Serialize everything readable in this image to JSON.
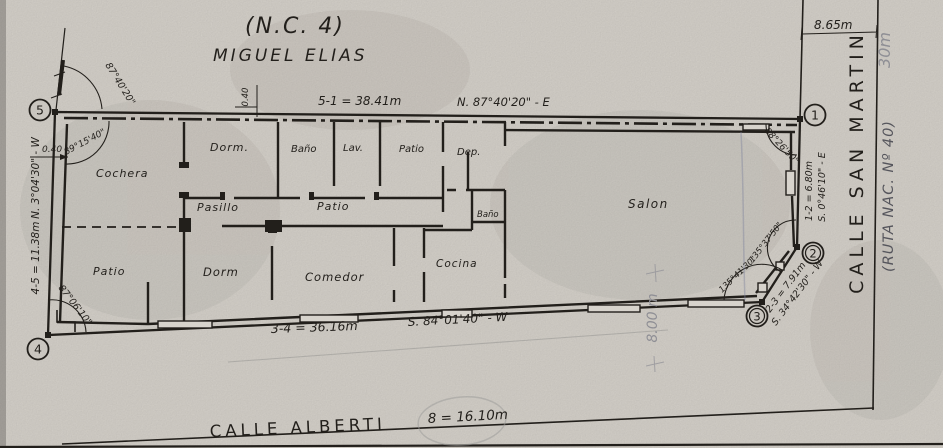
{
  "title": {
    "nc": "(N.C. 4)",
    "owner": "MIGUEL ELIAS"
  },
  "sides": {
    "north": {
      "dim": "5-1 = 38.41m",
      "bearing": "N. 87°40'20\" - E",
      "offset": "0.40"
    },
    "east": {
      "dim": "1-2 = 6.80m",
      "bearing": "S. 0°46'10\" - E",
      "corner_to_street": "8.65m"
    },
    "southeast": {
      "dim": "2-3 = 7.91m",
      "bearing": "S. 34°42'30\" - W"
    },
    "south": {
      "dim": "3-4 = 36.16m",
      "bearing": "S. 84°01'40\" - W"
    },
    "west": {
      "dim": "4-5 = 11.38m",
      "bearing": "N. 3°04'30\" - W",
      "offset": "0.40"
    }
  },
  "angles": {
    "v5_outer": "87°40'20\"",
    "v5_inner": "89°15'40\"",
    "v1": "88°26'50\"",
    "v2": "135°37'50\"",
    "v3": "135°41'30\"",
    "v4": "87°06'10\""
  },
  "vertices": {
    "v1": "1",
    "v2": "2",
    "v3": "3",
    "v4": "4",
    "v5": "5"
  },
  "rooms": {
    "cochera": "Cochera",
    "dorm1": "Dorm.",
    "bano1": "Baño",
    "lav": "Lav.",
    "patio_top": "Patio",
    "dep": "Dep.",
    "pasillo": "Pasillo",
    "patio_mid": "Patio",
    "bano2": "Baño",
    "salon": "Salon",
    "patio_sw": "Patio",
    "dorm2": "Dorm",
    "comedor": "Comedor",
    "cocina": "Cocina"
  },
  "streets": {
    "san_martin": {
      "name": "CALLE SAN MARTIN",
      "route": "(RUTA NAC. Nº 40)",
      "width": "30m"
    },
    "alberti": {
      "name": "CALLE ALBERTI",
      "width": "8 = 16.10m"
    }
  },
  "annotations": {
    "depth_pencil": "8.00 m"
  },
  "colors": {
    "paper": "#d7d3cc",
    "ink": "#221f1b",
    "pencil": "#8a8a90"
  }
}
